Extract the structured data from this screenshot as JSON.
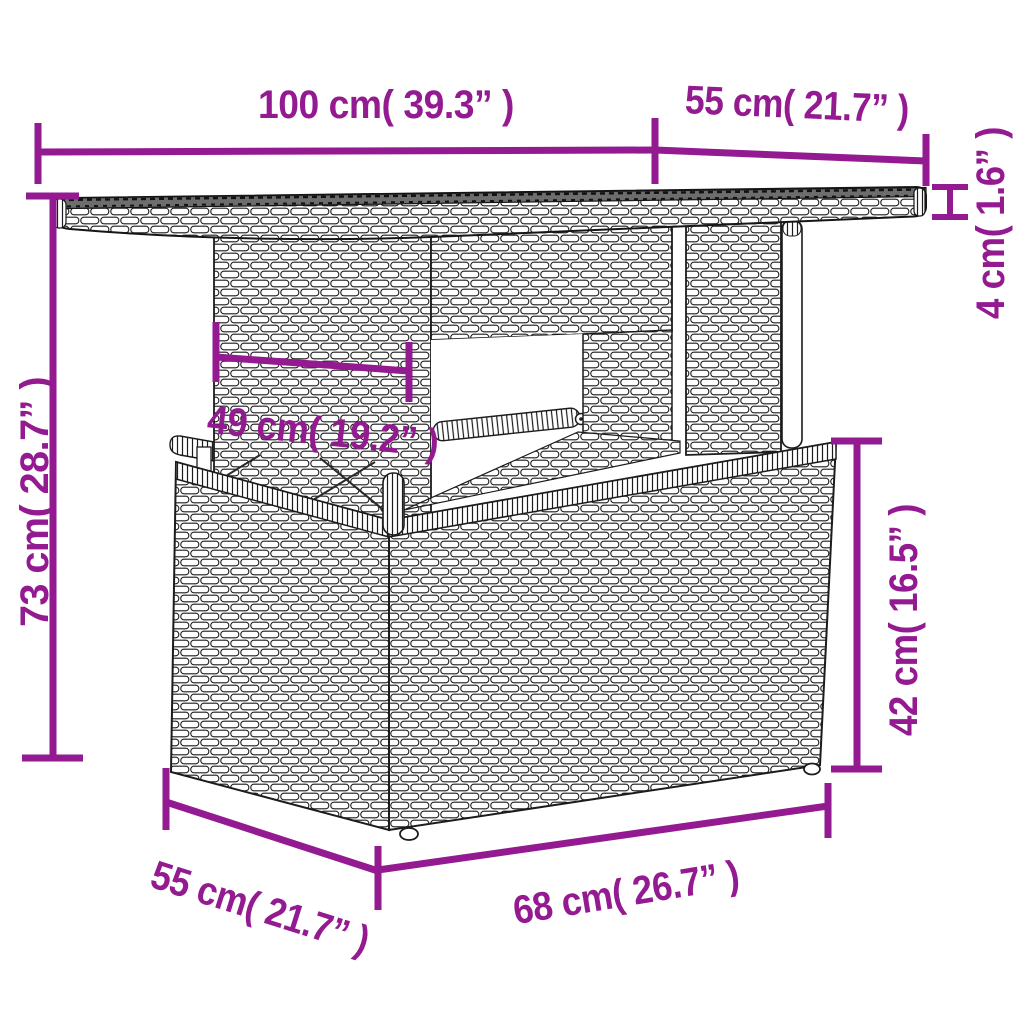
{
  "figure": {
    "kind": "product-dimension-diagram",
    "subject": "poly rattan garden table with glass/wood top, pedestal support and storage-box base"
  },
  "colors": {
    "dimension_annotation": "#931a90",
    "line_art": "#1c1c1c",
    "tabletop_surface": "#6d6d6d",
    "background": "#ffffff"
  },
  "dimensions": {
    "tabletop_width": {
      "label": "100 cm( 39.3” )",
      "value_cm": 100,
      "value_in": 39.3
    },
    "tabletop_depth": {
      "label": "55 cm( 21.7” )",
      "value_cm": 55,
      "value_in": 21.7
    },
    "tabletop_thickness": {
      "label": "4 cm( 1.6” )",
      "value_cm": 4,
      "value_in": 1.6
    },
    "table_height": {
      "label": "73 cm( 28.7” )",
      "value_cm": 73,
      "value_in": 28.7
    },
    "pedestal_width": {
      "label": "49 cm( 19.2” )",
      "value_cm": 49,
      "value_in": 19.2
    },
    "base_height": {
      "label": "42 cm( 16.5” )",
      "value_cm": 42,
      "value_in": 16.5
    },
    "base_depth": {
      "label": "55 cm( 21.7” )",
      "value_cm": 55,
      "value_in": 21.7
    },
    "base_width": {
      "label": "68 cm( 26.7” )",
      "value_cm": 68,
      "value_in": 26.7
    }
  }
}
